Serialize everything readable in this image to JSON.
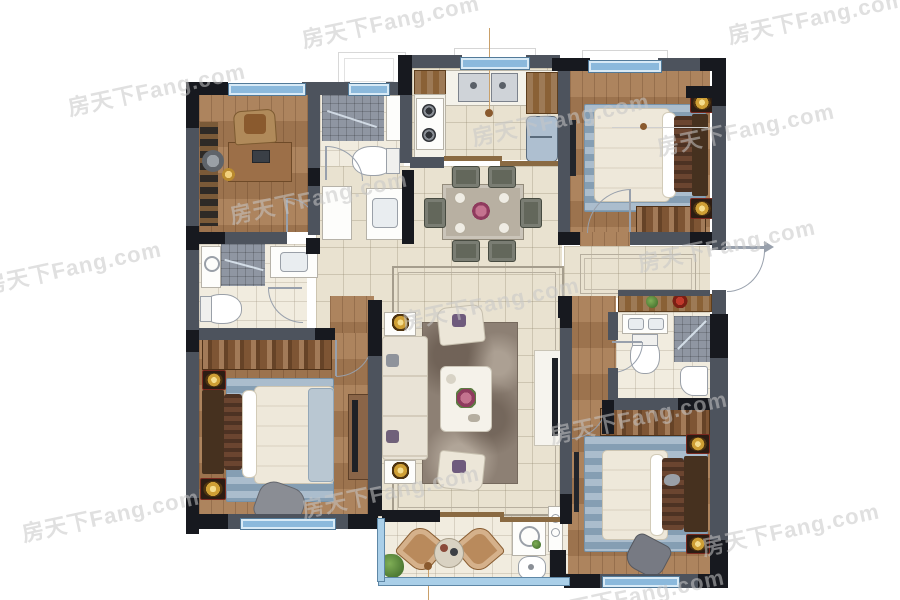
{
  "meta": {
    "image_type": "furnished residential apartment floor plan (top-down rendering)",
    "visible_text_note": "the only text rendered in the image is the repeated site watermark"
  },
  "watermark": {
    "text": "房天下Fang.com",
    "color": "#c7c7c7",
    "opacity": 0.55,
    "rotation_deg": -12,
    "positions": [
      {
        "x": 300,
        "y": 4
      },
      {
        "x": 726,
        "y": 0
      },
      {
        "x": 66,
        "y": 72
      },
      {
        "x": 470,
        "y": 102
      },
      {
        "x": 655,
        "y": 112
      },
      {
        "x": 228,
        "y": 180
      },
      {
        "x": 636,
        "y": 228
      },
      {
        "x": -18,
        "y": 250
      },
      {
        "x": 400,
        "y": 286
      },
      {
        "x": 548,
        "y": 400
      },
      {
        "x": 300,
        "y": 474
      },
      {
        "x": 20,
        "y": 498
      },
      {
        "x": 700,
        "y": 512
      },
      {
        "x": 545,
        "y": 578
      }
    ]
  },
  "palette": {
    "wall_gray": "#4d535d",
    "wall_black": "#17191f",
    "wood_floor": "#a87c54",
    "tile_floor": "#e9e2d0",
    "bath_tile": "#f1ecdf",
    "shower_mosaic": "#8f96a2",
    "window_blue": "#8bb9dc",
    "rug_blue": "#93abbf",
    "wardrobe_brown": "#7e5534",
    "lamp_gold": "#cf9f35",
    "lamp_base_red": "#79291f",
    "sofa_cream": "#eee8da"
  },
  "rooms": [
    {
      "id": "study",
      "position": "top-left",
      "floor": "wood",
      "furniture": [
        "bookshelf",
        "hanging-bowl-chair",
        "desk",
        "laptop",
        "desk-chair",
        "gold-table-lamp"
      ]
    },
    {
      "id": "bathroom-top",
      "position": "top, left of kitchen",
      "floor": "bath-tile",
      "furniture": [
        "shower-area",
        "tall-cabinet",
        "toilet",
        "storage-column",
        "vanity-sink"
      ]
    },
    {
      "id": "kitchen",
      "position": "top-center",
      "floor": "tile",
      "furniture": [
        "double-sink",
        "gas-stove-2-burner",
        "l-counter",
        "corner-cabinets",
        "refrigerator",
        "sliding-door",
        "pendant-leader-line"
      ]
    },
    {
      "id": "dining-room",
      "position": "center, below kitchen",
      "floor": "tile",
      "furniture": [
        "dining-table",
        "dining-chair x6",
        "centerpiece-flowers",
        "place-settings"
      ]
    },
    {
      "id": "bedroom-top-right",
      "position": "top-right",
      "floor": "wood",
      "furniture": [
        "double-bed",
        "headboard",
        "fur-pillows",
        "blue-area-rug",
        "bedside-lamp x2",
        "wardrobe",
        "wall-tv"
      ]
    },
    {
      "id": "entry-hall",
      "position": "middle-right",
      "floor": "tile",
      "furniture": [
        "entrance-door",
        "floor-mat-border",
        "console-shelf",
        "potted-plant",
        "red-flowers"
      ]
    },
    {
      "id": "bathroom-right",
      "position": "right, below entry",
      "floor": "bath-tile",
      "furniture": [
        "vanity-sink",
        "toilet",
        "corner-shower",
        "wash-basin"
      ]
    },
    {
      "id": "corridor",
      "position": "center-right",
      "floor": "wood",
      "furniture": []
    },
    {
      "id": "bedroom-bottom-right",
      "position": "bottom-right",
      "floor": "wood",
      "furniture": [
        "double-bed",
        "headboard",
        "fur-pillows",
        "blue-area-rug",
        "bedside-lamp x2",
        "wardrobe",
        "armchair",
        "wall-tv"
      ]
    },
    {
      "id": "master-bedroom",
      "position": "bottom-left",
      "floor": "wood",
      "furniture": [
        "double-bed",
        "headboard",
        "fur-pillows",
        "blue-area-rug",
        "bedside-lamp x2",
        "wardrobe",
        "armchair",
        "tv-board",
        "wall-tv"
      ]
    },
    {
      "id": "bathroom-left",
      "position": "middle-left",
      "floor": "bath-tile",
      "furniture": [
        "washing-machine",
        "shower-area",
        "vanity-sink",
        "toilet"
      ]
    },
    {
      "id": "living-room",
      "position": "center",
      "floor": "tile with inlay border",
      "furniture": [
        "sofa",
        "side-table-with-gold-lamp x2",
        "armchair x2",
        "coffee-table",
        "flower-centerpiece",
        "area-rug",
        "tv-cabinet",
        "wall-tv"
      ]
    },
    {
      "id": "balcony",
      "position": "bottom-center",
      "floor": "light-tile",
      "furniture": [
        "rattan-lounge-chair x2",
        "tea-table",
        "potted-plant",
        "laundry-cabinet",
        "water-heater",
        "round-wash-basin",
        "leader-line"
      ]
    }
  ],
  "windows": [
    {
      "room": "study",
      "wall": "top"
    },
    {
      "room": "bathroom-top",
      "wall": "top"
    },
    {
      "room": "kitchen",
      "wall": "top",
      "style": "bay outline"
    },
    {
      "room": "bedroom-top-right",
      "wall": "top",
      "style": "bay outline"
    },
    {
      "room": "master-bedroom",
      "wall": "bottom"
    },
    {
      "room": "balcony",
      "wall": "bottom",
      "style": "full-width glazing"
    },
    {
      "room": "balcony",
      "wall": "left",
      "style": "glazing"
    },
    {
      "room": "bedroom-bottom-right",
      "wall": "bottom"
    }
  ],
  "doors": [
    {
      "id": "entrance-door",
      "type": "swing with arrow",
      "location": "right wall of entry hall"
    },
    {
      "id": "study-door",
      "type": "swing",
      "location": "study bottom wall"
    },
    {
      "id": "bathroom-top-door",
      "type": "swing",
      "location": "inside top bathroom"
    },
    {
      "id": "bathroom-left-door",
      "type": "swing",
      "location": "hallway side"
    },
    {
      "id": "master-door",
      "type": "swing",
      "location": "hallway to master bedroom"
    },
    {
      "id": "bedroom-top-right-door",
      "type": "swing",
      "location": "entry hall side"
    },
    {
      "id": "bathroom-right-door",
      "type": "swing",
      "location": "corridor side"
    },
    {
      "id": "bedroom-bottom-right-door",
      "type": "swing",
      "location": "corridor side"
    },
    {
      "id": "kitchen-sliding-door",
      "type": "sliding",
      "location": "kitchen to dining"
    },
    {
      "id": "balcony-sliding-door",
      "type": "sliding",
      "location": "living room to balcony"
    }
  ],
  "exterior_features": [
    {
      "id": "ac-platform-outline",
      "location": "above top bathroom"
    },
    {
      "id": "bay-window-outline",
      "location": "above kitchen window"
    },
    {
      "id": "bay-window-outline",
      "location": "above top-right bedroom window"
    }
  ]
}
